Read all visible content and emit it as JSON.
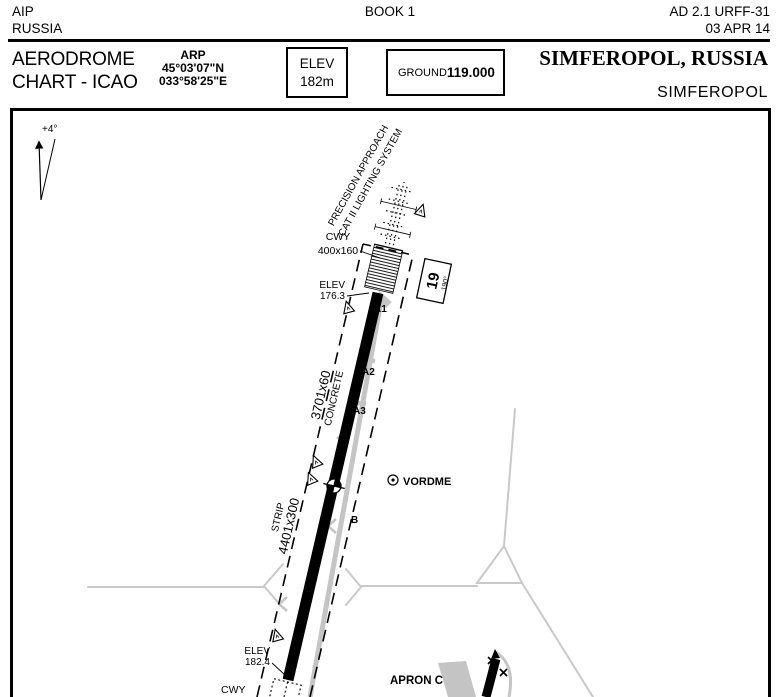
{
  "page_header": {
    "publication": "AIP",
    "country": "RUSSIA",
    "book": "BOOK 1",
    "reference": "AD 2.1 URFF-31",
    "date": "03 APR 14"
  },
  "title_block": {
    "chart_title_line1": "AERODROME",
    "chart_title_line2": "CHART - ICAO",
    "arp": {
      "label": "ARP",
      "lat": "45°03'07\"N",
      "lon": "033°58'25\"E"
    },
    "elevation": {
      "label": "ELEV",
      "value": "182m"
    },
    "ground": {
      "label": "GROUND",
      "frequency": "119.000"
    },
    "city": "SIMFEROPOL, RUSSIA",
    "aerodrome": "SIMFEROPOL"
  },
  "chart": {
    "magnetic_variation": "+4°",
    "approach_lighting": {
      "line1": "PRECISION APPROACH",
      "line2": "CAT II LIGHTING SYSTEM"
    },
    "clearway_top": {
      "label": "CWY",
      "dimensions": "400x160"
    },
    "threshold_19": {
      "label": "ELEV",
      "value": "176.3"
    },
    "runway": {
      "designator": "19",
      "heading": "190°",
      "dimensions": "3701x60",
      "surface": "CONCRETE"
    },
    "strip": {
      "label": "STRIP",
      "dimensions": "4401x300"
    },
    "taxiways": {
      "a1": "A1",
      "a2": "A2",
      "a3": "A3",
      "b": "B"
    },
    "navaid": {
      "label": "VORDME"
    },
    "threshold_01": {
      "label": "ELEV",
      "value": "182.4"
    },
    "apron": {
      "label": "APRON C"
    },
    "clearway_bottom": {
      "label": "CWY"
    }
  },
  "colors": {
    "ink": "#000000",
    "road": "#c9c9c9",
    "taxiway": "#c5c5c5",
    "apron": "#c4c4c4"
  }
}
